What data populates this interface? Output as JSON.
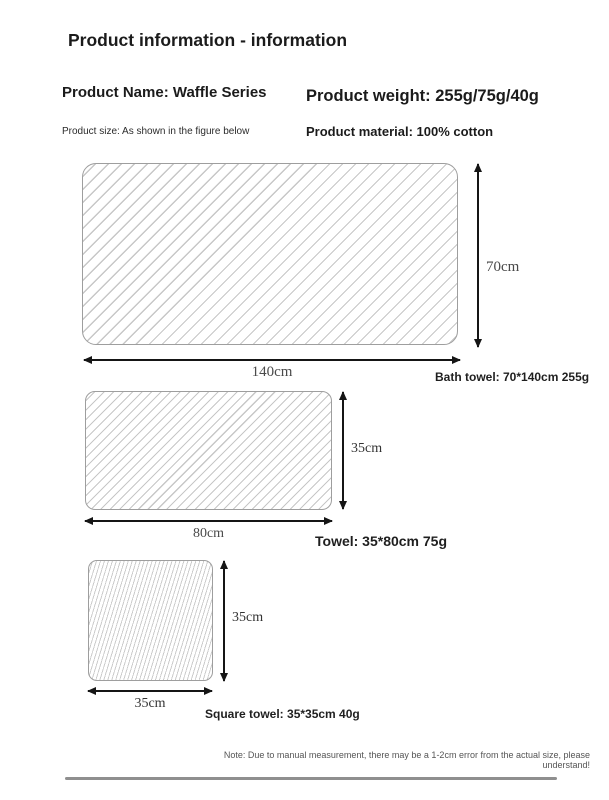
{
  "page": {
    "title": "Product information - information"
  },
  "info": {
    "name": "Product Name: Waffle Series",
    "weight": "Product weight: 255g/75g/40g",
    "size_note": "Product size: As shown in the figure below",
    "material": "Product material: 100% cotton"
  },
  "diagrams": [
    {
      "width_label": "140cm",
      "height_label": "70cm",
      "caption": "Bath towel: 70*140cm 255g"
    },
    {
      "width_label": "80cm",
      "height_label": "35cm",
      "caption": "Towel: 35*80cm 75g"
    },
    {
      "width_label": "35cm",
      "height_label": "35cm",
      "caption": "Square towel: 35*35cm 40g"
    }
  ],
  "footer": {
    "note": "Note: Due to manual measurement, there may be a 1-2cm error from the actual size, please understand!"
  },
  "colors": {
    "hatch_line": "#c7c7c7",
    "shape_outline": "#9e9e9e",
    "arrow": "#151515",
    "text_dark": "#1b1b1b"
  }
}
